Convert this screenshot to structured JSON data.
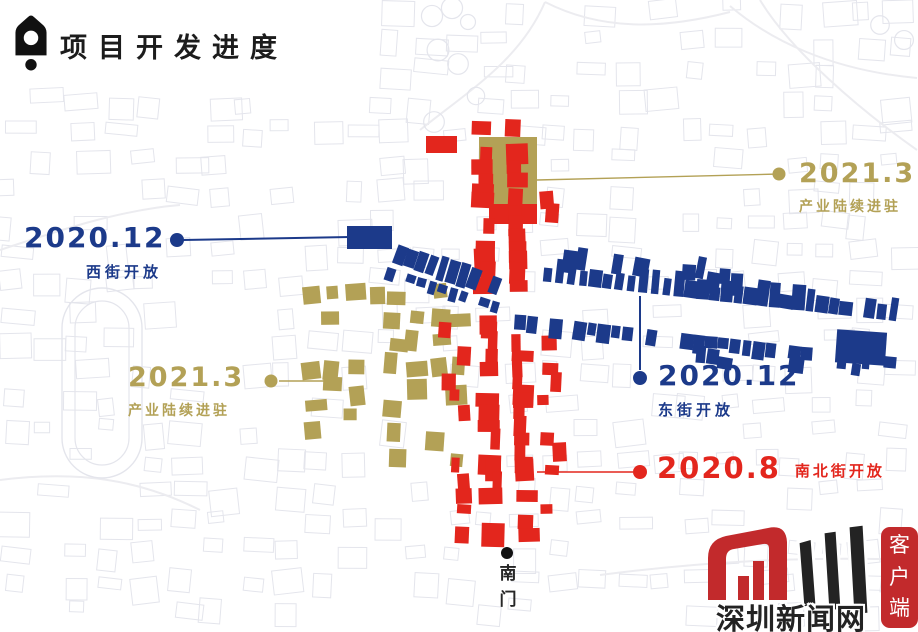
{
  "header": {
    "title": "项目开发进度"
  },
  "colors": {
    "blue": "#1c3a8a",
    "red": "#e3261d",
    "gold": "#b3a156",
    "ink": "#1c1c1c",
    "bg_line": "#e4e5ec",
    "road_line": "#ececf0",
    "logo_red": "#c22a2c",
    "logo_dark": "#232323"
  },
  "annotations": {
    "west_street": {
      "date": "2020.12",
      "label": "西街开放",
      "color": "blue"
    },
    "industry_northeast": {
      "date": "2021.3",
      "label": "产业陆续进驻",
      "color": "gold"
    },
    "east_street": {
      "date": "2020.12",
      "label": "东街开放",
      "color": "blue"
    },
    "industry_west": {
      "date": "2021.3",
      "label": "产业陆续进驻",
      "color": "gold"
    },
    "north_south_street": {
      "date": "2020.8",
      "label": "南北街开放",
      "color": "red"
    },
    "south_gate": {
      "label": "南门"
    }
  },
  "watermark": {
    "site": "深圳新闻网",
    "badge": "客户端"
  }
}
